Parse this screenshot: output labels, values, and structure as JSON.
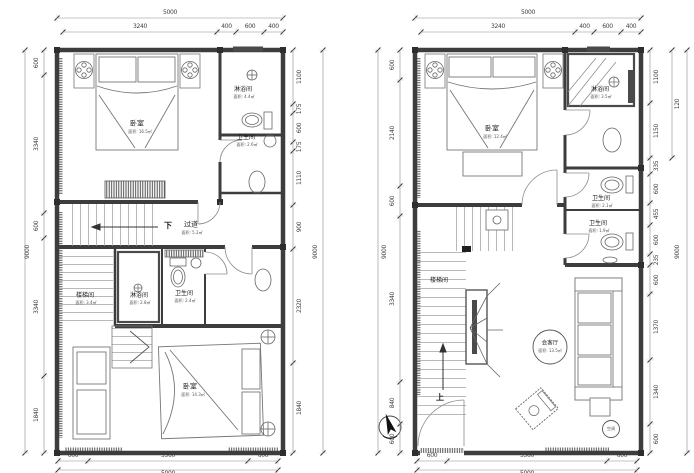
{
  "page": {
    "background": "#ffffff",
    "wall_color": "#3d3d3d",
    "dim_color": "#3f3f3f"
  },
  "plans": {
    "left": {
      "dims": {
        "top_total": [
          "5000"
        ],
        "top_chain": [
          "3240",
          "400",
          "600",
          "400"
        ],
        "bottom_chain": [
          "600",
          "3560",
          "600"
        ],
        "bottom_total": [
          "5000"
        ],
        "left_total": [
          "9000"
        ],
        "left_chain": [
          "600",
          "3340",
          "600",
          "3340",
          "1840"
        ],
        "right_chain": [
          "1100",
          "175",
          "600",
          "175",
          "1110",
          "900",
          "2320",
          "1840"
        ],
        "right_total": [
          "9000"
        ]
      },
      "rooms": {
        "bedroom_top": {
          "name": "卧室",
          "area": "面积: 16.5㎡"
        },
        "shower_top": {
          "name": "淋浴间",
          "area": "面积: 4.4㎡"
        },
        "bath_top": {
          "name": "卫生间",
          "area": "面积: 2.6㎡"
        },
        "corridor": {
          "name": "过道",
          "area": "面积: 5.2㎡",
          "direction": "下"
        },
        "stair_mid": {
          "name": "楼梯间",
          "area": "面积: 3.4㎡"
        },
        "shower_mid": {
          "name": "淋浴间",
          "area": "面积: 2.8㎡"
        },
        "bath_mid": {
          "name": "卫生间",
          "area": "面积: 2.4㎡"
        },
        "bedroom_bottom": {
          "name": "卧室",
          "area": "面积: 14.3㎡"
        }
      }
    },
    "right": {
      "dims": {
        "top_total": [
          "5000"
        ],
        "top_chain": [
          "3240",
          "400",
          "600",
          "400"
        ],
        "bottom_chain": [
          "600",
          "3560",
          "600"
        ],
        "bottom_total": [
          "5000"
        ],
        "left_total": [
          "9000"
        ],
        "left_chain": [
          "600",
          "2140",
          "600",
          "3340",
          "840",
          "600"
        ],
        "right_chain": [
          "1100",
          "1150",
          "335",
          "600",
          "455",
          "600",
          "235",
          "600",
          "1370",
          "1340",
          "600"
        ],
        "right_mid": [
          "120"
        ],
        "right_total": [
          "9000"
        ]
      },
      "rooms": {
        "bedroom": {
          "name": "卧室",
          "area": "面积: 12.4㎡"
        },
        "shower": {
          "name": "淋浴间",
          "area": "面积: 3.5㎡"
        },
        "bath_upper": {
          "name": "卫生间",
          "area": "面积: 2.1㎡"
        },
        "bath_lower": {
          "name": "卫生间",
          "area": "面积: 1.9㎡"
        },
        "stair": {
          "name": "楼梯间"
        },
        "living": {
          "name": "会客厅",
          "area": "面积: 13.5㎡"
        },
        "up_label": "上",
        "ac_label": "空调"
      }
    }
  }
}
